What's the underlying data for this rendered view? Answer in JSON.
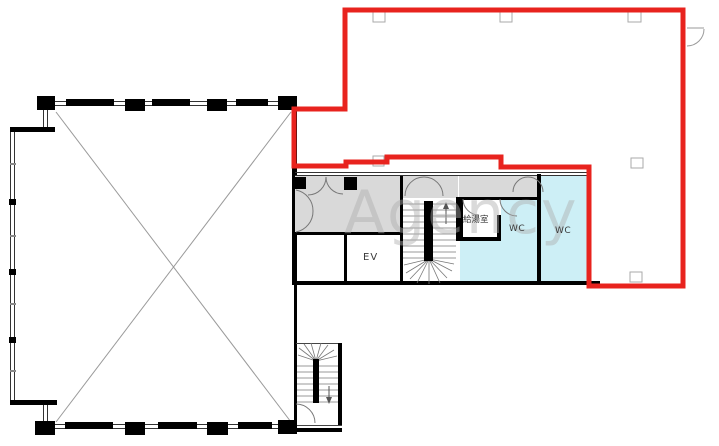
{
  "floorplan": {
    "watermark_text": "Agency",
    "labels": {
      "elevator": "EV",
      "kitchenette": "給湯室",
      "wc_left": "WC",
      "wc_right": "WC"
    },
    "colors": {
      "highlight_outline": "#e8231e",
      "wc_fill": "#cdeff6",
      "corridor_fill": "#d9d9d9",
      "wall": "#000000",
      "watermark": "#aeaeae"
    }
  }
}
